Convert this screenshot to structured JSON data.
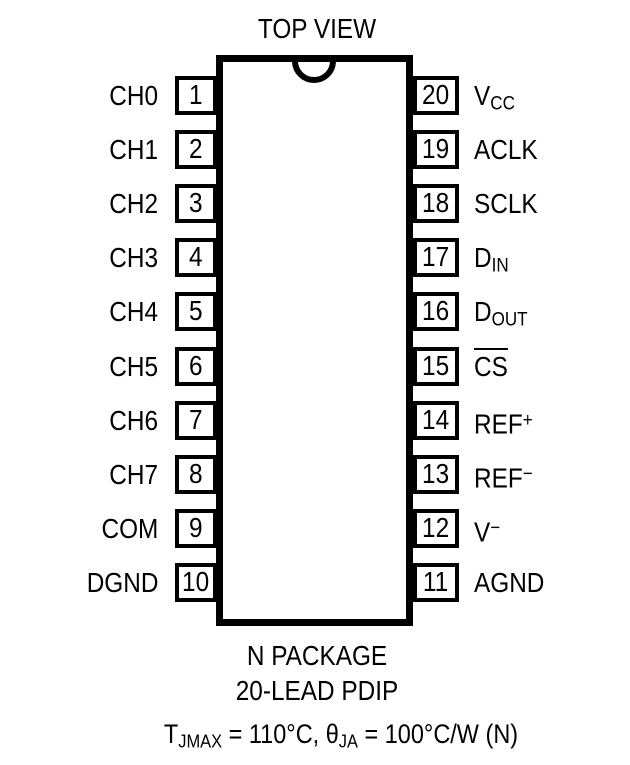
{
  "diagram": {
    "title": "TOP VIEW",
    "package_name": "N PACKAGE",
    "package_type": "20-LEAD PDIP",
    "colors": {
      "ink": "#000000",
      "background": "#ffffff"
    },
    "pins": {
      "left": [
        {
          "number": "1",
          "label": {
            "base": "CH0"
          }
        },
        {
          "number": "2",
          "label": {
            "base": "CH1"
          }
        },
        {
          "number": "3",
          "label": {
            "base": "CH2"
          }
        },
        {
          "number": "4",
          "label": {
            "base": "CH3"
          }
        },
        {
          "number": "5",
          "label": {
            "base": "CH4"
          }
        },
        {
          "number": "6",
          "label": {
            "base": "CH5"
          }
        },
        {
          "number": "7",
          "label": {
            "base": "CH6"
          }
        },
        {
          "number": "8",
          "label": {
            "base": "CH7"
          }
        },
        {
          "number": "9",
          "label": {
            "base": "COM"
          }
        },
        {
          "number": "10",
          "label": {
            "base": "DGND"
          }
        }
      ],
      "right": [
        {
          "number": "20",
          "label": {
            "base": "V",
            "sub": "CC"
          }
        },
        {
          "number": "19",
          "label": {
            "base": "ACLK"
          }
        },
        {
          "number": "18",
          "label": {
            "base": "SCLK"
          }
        },
        {
          "number": "17",
          "label": {
            "base": "D",
            "sub": "IN"
          }
        },
        {
          "number": "16",
          "label": {
            "base": "D",
            "sub": "OUT"
          }
        },
        {
          "number": "15",
          "label": {
            "base": "CS",
            "overline": true
          }
        },
        {
          "number": "14",
          "label": {
            "base": "REF",
            "sup": "+"
          }
        },
        {
          "number": "13",
          "label": {
            "base": "REF",
            "sup": "−"
          }
        },
        {
          "number": "12",
          "label": {
            "base": "V",
            "sup": "−"
          }
        },
        {
          "number": "11",
          "label": {
            "base": "AGND"
          }
        }
      ]
    },
    "thermal_note_parts": [
      {
        "text": "T"
      },
      {
        "sub": "JMAX"
      },
      {
        "text": " = 110°C, θ"
      },
      {
        "sub": "JA"
      },
      {
        "text": " = 100°C/W (N)"
      }
    ]
  }
}
